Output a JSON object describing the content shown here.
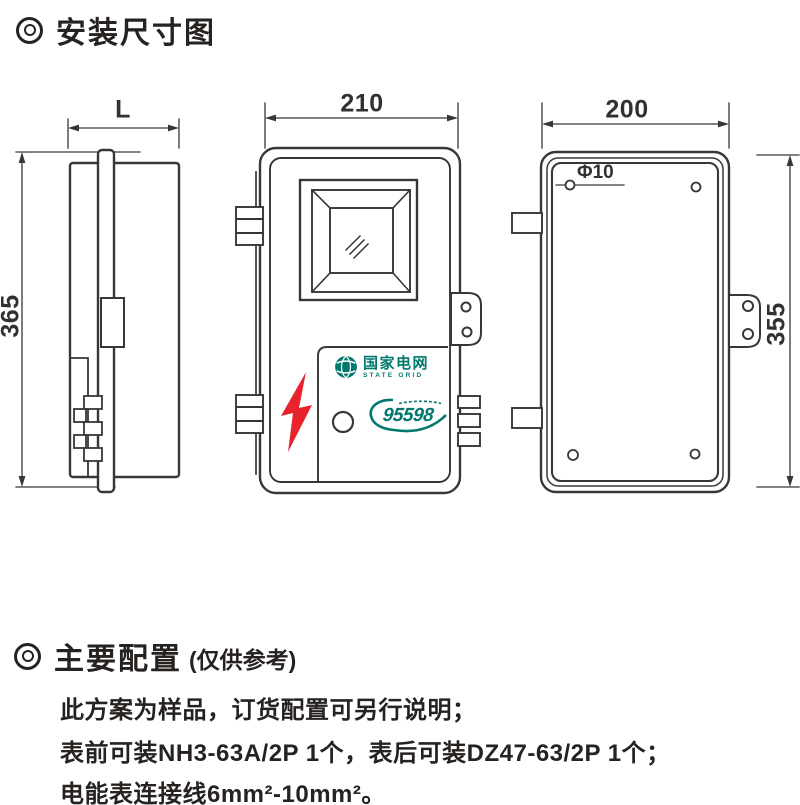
{
  "sections": {
    "dimensions": {
      "title": "安装尺寸图"
    },
    "configuration": {
      "title": "主要配置",
      "subtitle": "(仅供参考)"
    }
  },
  "notes": [
    "此方案为样品，订货配置可另行说明；",
    "表前可装NH3-63A/2P 1个，表后可装DZ47-63/2P 1个；",
    "电能表连接线6mm²-10mm²。"
  ],
  "dims": {
    "side_width": "L",
    "side_height": "365",
    "front_width": "210",
    "rear_width": "200",
    "rear_height": "355",
    "hole": "Φ10"
  },
  "brand": {
    "name_cn": "国家电网",
    "name_en": "STATE GRID",
    "hotline": "95598"
  },
  "colors": {
    "ink": "#34302e",
    "line": "#3a3633",
    "accent_red": "#e8232e",
    "brand_teal": "#00786e"
  }
}
